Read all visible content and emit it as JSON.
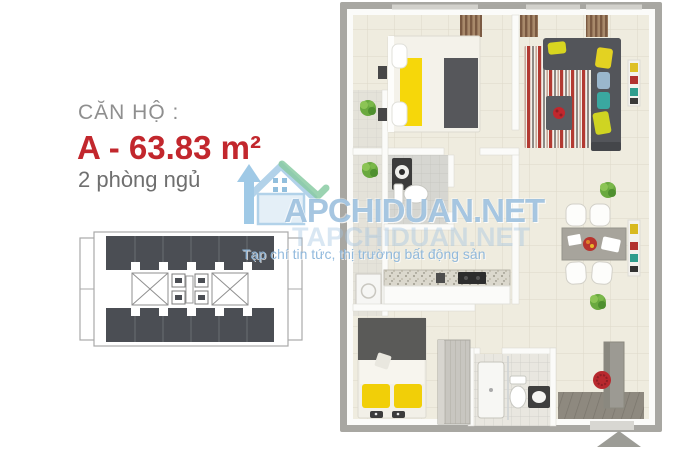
{
  "unit_info": {
    "label": "CĂN HỘ :",
    "area": "A - 63.83 m²",
    "bedrooms": "2 phòng ngủ"
  },
  "watermark": {
    "brand": "APCHIDUAN.NET",
    "brand_echo": "TAPCHIDUAN.NET",
    "tagline": "Tạp chí tin tức, thị trường bất động sản"
  },
  "key_plan": {
    "units_top_row": 6,
    "units_bottom_row": 6,
    "stairwells": 2,
    "elevator_cells": 4
  },
  "floor_plan": {
    "rooms": [
      "bedroom-1",
      "living-room",
      "bathroom-1",
      "kitchen",
      "service-balcony",
      "bedroom-2",
      "bathroom-2",
      "dining-area",
      "entry-hall",
      "wardrobe"
    ],
    "entrance_marker": "triangle-up"
  },
  "colors": {
    "accent_red": "#c2272d",
    "label_gray": "#8f8f8f",
    "text_gray": "#6f6f6f",
    "watermark_blue": "#92bada",
    "watermark_green": "#74c293",
    "outer_wall_gray": "#a8a7a2",
    "floor_cream": "#efecdf",
    "key_unit_dark": "#4b4e54",
    "bed_yellow": "#f1cf08",
    "sofa_gray": "#53555a",
    "rug_red": "#b23a32",
    "plant_green": "#6aa93f",
    "wreath_red": "#b8292e"
  }
}
